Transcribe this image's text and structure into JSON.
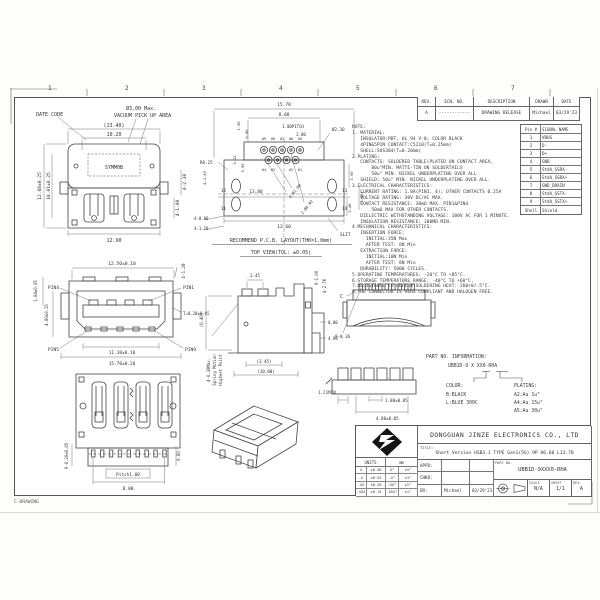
{
  "colors": {
    "ink": "#333333",
    "line": "#444444",
    "dim": "#666666",
    "paper": "#ffffff"
  },
  "sheet": {
    "ruler": [
      "1",
      "2",
      "3",
      "4",
      "5",
      "6",
      "7"
    ],
    "corner_label": "C-DRAWING"
  },
  "rev_table": {
    "headers": [
      "REV.",
      "ECN. NO.",
      "DESCRIPTION",
      "DRAWN",
      "DATE"
    ],
    "row": {
      "rev": "A",
      "ecn": "------------",
      "desc": "DRAWING RELEASE",
      "drawn": "Michael",
      "date": "03/29'23"
    }
  },
  "pin_table": {
    "col_pin": "Pin #",
    "col_signal": "SIGNAL NAME",
    "rows": [
      {
        "pin": "1",
        "signal": "VBUS"
      },
      {
        "pin": "2",
        "signal": "D-"
      },
      {
        "pin": "3",
        "signal": "D+"
      },
      {
        "pin": "4",
        "signal": "GND"
      },
      {
        "pin": "5",
        "signal": "StdA_SSRX-"
      },
      {
        "pin": "6",
        "signal": "StdA_SSRX+"
      },
      {
        "pin": "7",
        "signal": "GND_DRAIN"
      },
      {
        "pin": "8",
        "signal": "StdA_SSTX-"
      },
      {
        "pin": "9",
        "signal": "StdA_SSTX+"
      },
      {
        "pin": "Shell",
        "signal": "Shield"
      }
    ]
  },
  "notes": {
    "lines": [
      "NOTE:",
      "1. MATERIAL:",
      "   INSULATOR:PBT, UL 94 V-0; COLOR BLACK",
      "   4PIN&5PIN CONTACT:C5210(T=0.25mm)",
      "   SHELL:SUS304(T=0.20mm)",
      "2.PLATING:",
      "   CONTACTS: SOLDERED TABLE(PLATED ON CONTACT AREA,",
      "       80u\"MIN. MATTE-TIN ON SOLDERTAILS",
      "       50u\" MIN. NICKEL UNDERPLATING OVER ALL",
      "   SHIELD: 50u\" MIN. NICKEL UNDERPLATING OVER ALL.",
      "3.ELECTRICAL CHARACTERISTICS:",
      "   CURRENT RATING: 1.8A(PIN1, 4); OTHER CONTACTS 0.25A",
      "   VOLTAGE RATING: 30V DC/AC MAX.",
      "   CONTACT RESISTANCE: 30mΩ MAX. PIN1&PIN4",
      "       50mΩ MAX FOR OTHER CONTACTS.",
      "   DIELECTRIC WITHSTANDING VOLTAGE: 100V AC FOR 1 MINUTE.",
      "   INSULATION RESISTANCE: 100MΩ MIN.",
      "4.MECHANICAL CHARACTERISTICS:",
      "   INSERTION FORCE:",
      "     INITIAL:35N Max",
      "     AFTER TEST: 8N Min",
      "   EXTRACTION FORCE:",
      "     INITIAL:10N Min",
      "     AFTER TEST: 8N Min",
      "   DURABILITY: 5000 CYCLES.",
      "5.OPERATING TEMPERATURES: -20°C TO +85°C.",
      "6.STORAGE TEMPERATURE RANGE: -40°C TO +60°C.",
      "7.RESISTANCE TO REFLOW SOLDERING HEAT: 260+0/-5°C.",
      "8.THE CONNECTOR IS RoHS COMPLIANT AND HALOGEN FREE."
    ]
  },
  "part_info": {
    "heading": "PART NO. INFORMATION:",
    "part_code": "UBB1D-9 X XX0-RHA",
    "color_label": "COLOR:",
    "color_options": [
      "B:BLACK",
      "L:BLUE 300C"
    ],
    "plating_label": "PLATING:",
    "plating_options": [
      "A2:Au 1u\"",
      "A4:Au 15u\"",
      "A5:Au 30u\""
    ]
  },
  "title_block": {
    "company": "DONGGUAN JINZE ELECTRONICS CO., LTD",
    "title_label": "TITLE:",
    "title": "Short Version USB3.1 TYPE Gen1(5G) 9P H6.60 L13.70",
    "units_label": "UNITS",
    "units_unit": "mm",
    "tol_rows": [
      [
        "X",
        "±0.30",
        "X°",
        "±5°"
      ],
      [
        ".X",
        "±0.25",
        ".X°",
        "±3°"
      ],
      [
        ".XX",
        "±0.20",
        ".XX°",
        "±2°"
      ],
      [
        ".XXX",
        "±0.15",
        ".XXX°",
        "±1°"
      ]
    ],
    "appd_label": "APPD:",
    "chkd_label": "CHKD:",
    "dr_label": "DR:",
    "dr_name": "Michael",
    "dr_date": "03/29'23",
    "part_no_label": "PART NO.",
    "part_no": "UBB1D-9XXX0-RHA",
    "scale_label": "SCALE",
    "scale": "N/A",
    "sheet_label": "SHEET",
    "sheet": "1/1",
    "rev_label": "REV.",
    "rev": "A"
  },
  "views": {
    "shell_top": {
      "labels": {
        "date_code": "DATE CODE",
        "vacuum_1": "Ø3.00 Max.",
        "vacuum_2": "VACUUM PICK UP AREA",
        "marking": "SYMM0B"
      },
      "dims": {
        "width_ref": "(13.40)",
        "width_inner": "10.20",
        "height_left": "12.68±0.25",
        "height_inner": "10.01±0.25",
        "width_bottom": "12.90",
        "legs": "4-2.30",
        "legs2": "4-1.00"
      }
    },
    "pcb": {
      "title1": "RECOMMEND P.C.B. LAYOUT(THK=1.0mm)",
      "title2": "TOP VIEW(TOL: ±0.05)",
      "dims": {
        "width": "15.70",
        "row_width": "8.00",
        "pitch": "1.00PITCH",
        "row_gap": "2.00",
        "hole_shell": "Ø2.30",
        "r_notch": "R0.25",
        "holes_sig": "4-Ø1.00",
        "holes_ss": "2-Ø0.92",
        "len_inner": "13.80",
        "len_outer": "13.60",
        "side_a": "3.90",
        "side_b": "2.48",
        "side_ref": "(5.96)",
        "off_a": "3.12",
        "off_b": "3.50",
        "off_c": "1.56",
        "off_d": "0.80",
        "slot_a": "4-1.45",
        "slot_b": "4-0.80",
        "slot_c": "4-1.20",
        "slit": "SLIT"
      },
      "pad_labels": {
        "p12": "12",
        "p11": "11",
        "p13": "13",
        "p14": "14"
      },
      "hole_labels_top": [
        "#9",
        "#8",
        "#7",
        "#6",
        "#5"
      ],
      "hole_labels_bot": [
        "#4",
        "#3",
        "#2",
        "#1"
      ]
    },
    "front": {
      "pins": {
        "pin4": "PIN4",
        "pin1": "PIN1",
        "pin5": "PIN5",
        "pin9": "PIN9"
      },
      "dims": {
        "width_top": "12.50±0.10",
        "tab": "1.84±0.05",
        "height": "4.80±0.15",
        "corner": "4-1.20",
        "shell_t": "T=0.20±0.05",
        "width_tongue": "11.10±0.10",
        "width_all": "15.70±0.20"
      }
    },
    "side": {
      "label_1": "4-0.30Max.",
      "label_2": "Spring Motion",
      "label_3": "Highest Point",
      "dims": {
        "latch": "2.45",
        "pins": "9-1.00",
        "tails": "4-2.76",
        "tail_w": "0.80",
        "tail_l": "4.90",
        "body": "(3.45)",
        "total": "(10.00)",
        "height_ref": "(6.40)"
      }
    },
    "rear": {
      "section": "C",
      "dims": {
        "teeth": "9-0.36"
      }
    },
    "bottom": {
      "dims": {
        "pitch": "Pitch1.00",
        "row": "8.00",
        "pads": "9-0.20±0.05",
        "edge": "0.80"
      }
    },
    "tail_detail": {
      "dims": {
        "min": "1.21MIN",
        "pitch": "1.00±0.05",
        "span": "4.00±0.05"
      }
    }
  }
}
